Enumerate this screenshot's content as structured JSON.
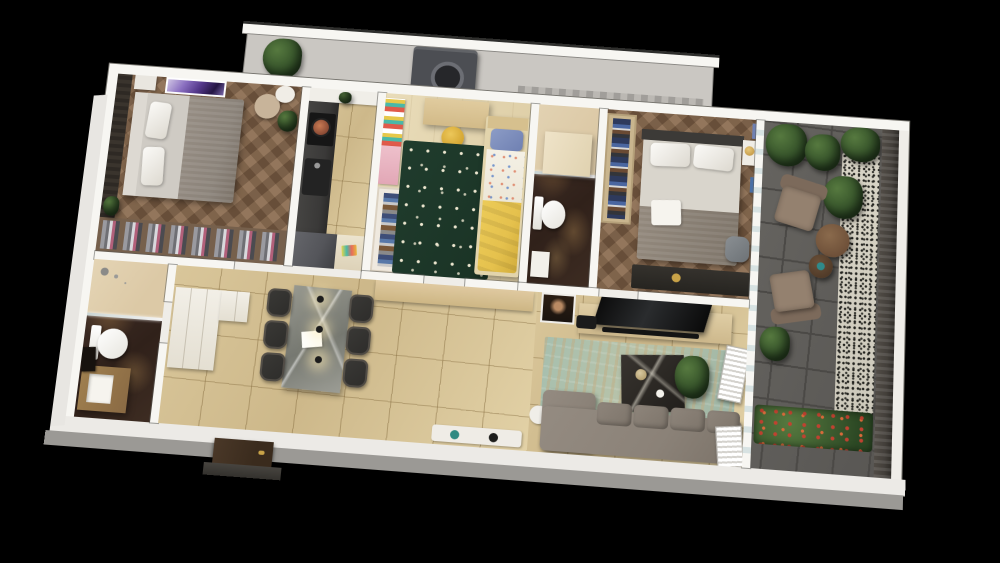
{
  "scene": {
    "type": "3d-apartment-floor-plan-render",
    "view": "isometric-top-down",
    "rooms": [
      {
        "name": "master-bedroom",
        "floor": "herringbone-wood",
        "furniture": [
          "double-bed",
          "accent-wall",
          "wall-art",
          "vanity-chair",
          "plant",
          "open-closet"
        ]
      },
      {
        "name": "kitchen",
        "floor": "beige-tile",
        "furniture": [
          "dark-counter",
          "stove",
          "sink",
          "refrigerator",
          "light-counter"
        ]
      },
      {
        "name": "kids-bedroom",
        "floor": "light-wood",
        "furniture": [
          "single-bed-yellow",
          "desk",
          "yellow-chair",
          "wardrobe",
          "green-star-rug",
          "pink-shelf"
        ]
      },
      {
        "name": "bathroom-1",
        "floor": "dark-marble",
        "furniture": [
          "shower",
          "vanity",
          "toilet"
        ]
      },
      {
        "name": "bedroom-2",
        "floor": "herringbone-wood",
        "furniture": [
          "double-bed",
          "open-wardrobe",
          "nightstand",
          "gold-lamp",
          "dresser",
          "lounge-chair"
        ]
      },
      {
        "name": "living-room",
        "floor": "beige-tile",
        "furniture": [
          "sofa",
          "coffee-table",
          "tv-console",
          "tv",
          "soundbar",
          "teal-rug",
          "plant",
          "portrait-art"
        ]
      },
      {
        "name": "dining-area",
        "floor": "beige-tile",
        "furniture": [
          "marble-dining-table",
          "six-chairs",
          "pendant-lights",
          "sideboard",
          "wall-shelf"
        ]
      },
      {
        "name": "hallway",
        "floor": "beige-tile",
        "furniture": [
          "white-cabinets",
          "entrance-door",
          "door-mat"
        ]
      },
      {
        "name": "bathroom-2",
        "floor": "dark-marble",
        "furniture": [
          "shower",
          "toilet",
          "vanity",
          "mirror"
        ]
      },
      {
        "name": "balcony",
        "floor": "dark-gray-tile",
        "furniture": [
          "two-armchairs",
          "round-side-tables",
          "potted-plants",
          "speckled-runner-rug",
          "flower-planters",
          "slatted-railing",
          "white-shutters"
        ]
      },
      {
        "name": "service-balcony",
        "floor": "gray-concrete",
        "furniture": [
          "washing-machine",
          "potted-plant"
        ]
      }
    ]
  },
  "colors": {
    "background": "#000000",
    "wall": "#f7f6f2",
    "wall-edge": "#85837f",
    "wood": "#8d6f53",
    "wood-shadow": "#73573f",
    "wood-light": "#e6d8b2",
    "tile": "#d9c69a",
    "tile-line": "#b79d6b",
    "marble-dark": "#3a2a20",
    "marble-vein": "#a0744a",
    "marble-light": "#dcc9a6",
    "rug-green": "#203c2d",
    "rug-dot": "#ece6cf",
    "rug-teal": "#a7bfae",
    "rug-tan": "#c3ab7f",
    "speckle-base": "#d8d4c6",
    "balcony-tile": "#605e5a",
    "balcony-line": "#4b4946",
    "railing": "#433f3a",
    "sofa": "#8b8278",
    "sofa-dark": "#7d746a",
    "armchair": "#94816f",
    "table-wood": "#6d4f38",
    "counter-dark": "#3a3938",
    "fridge": "#54555a",
    "cabinet-white": "#efece4",
    "bed-yellow": "#e5c14d",
    "duvet-white": "#f3efe4",
    "pillow-blue": "#6f80b2",
    "bed-gray": "#8b837a",
    "mattress": "#d9d5cc",
    "marble-table": "#8e8f89",
    "chair-dark": "#2d2c2a",
    "pendant": "#1c1c1c",
    "door": "#3a2b1d",
    "plant-dark": "#2c4824",
    "plant-light": "#56793f",
    "accent-purple": "#55398c",
    "washer": "#4c4e53",
    "service-floor": "#cac7c2",
    "glass": "#d8e6e6",
    "skin": "#b98a63"
  }
}
